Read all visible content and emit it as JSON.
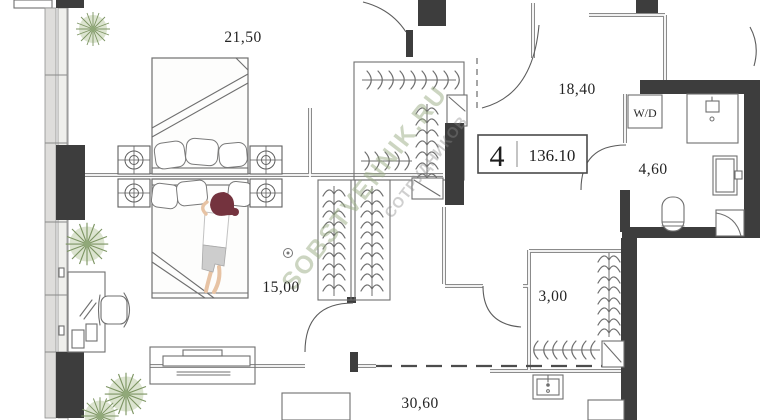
{
  "apartment": {
    "number": "4",
    "total_area": "136.10"
  },
  "rooms": [
    {
      "name": "bedroom-1",
      "area": "21,50"
    },
    {
      "name": "hallway",
      "area": "18,40"
    },
    {
      "name": "bathroom",
      "area": "4,60"
    },
    {
      "name": "bedroom-2",
      "area": "15,00"
    },
    {
      "name": "wardrobe-corridor",
      "area": "3,00"
    },
    {
      "name": "living-kitchen",
      "area": "30,60"
    }
  ],
  "labels": {
    "washer_dryer": "W/D"
  },
  "watermark": {
    "brand": "SOBSTVENNIK.RU",
    "caption": "СОТРУДНИКОВ"
  },
  "colors": {
    "wall": "#3d3d3d",
    "line": "#6f6f6f",
    "plant": "#7d9563",
    "watermark": "#9aad85"
  }
}
